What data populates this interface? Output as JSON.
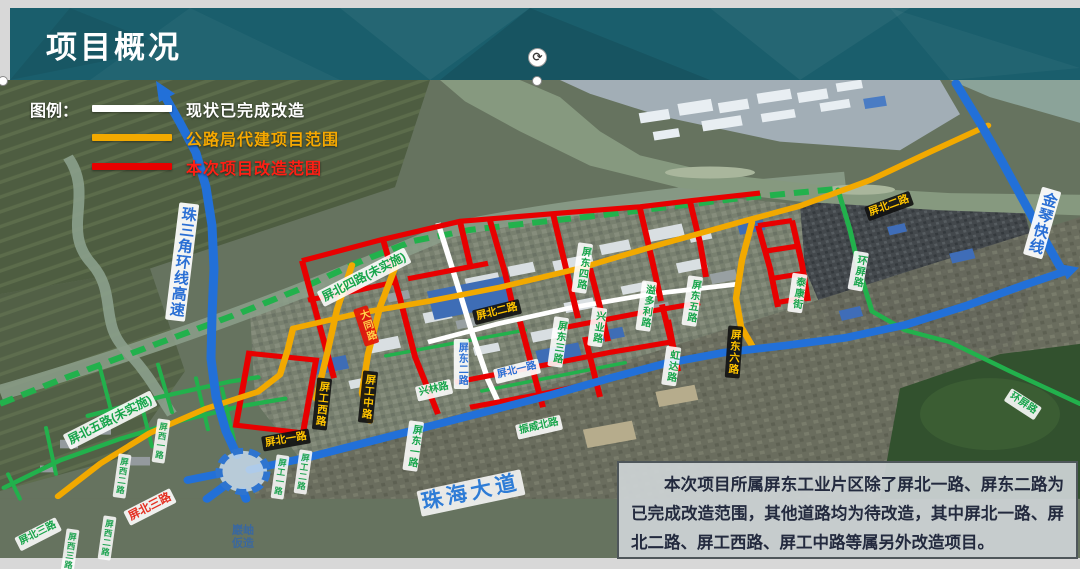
{
  "banner": {
    "title": "项目概况",
    "bg_color": "#1a5e6c"
  },
  "legend": {
    "title": "图例：",
    "items": [
      {
        "label": "现状已完成改造",
        "color": "#ffffff",
        "text_color": "#ffffff"
      },
      {
        "label": "公路局代建项目范围",
        "color": "#f2a900",
        "text_color": "#f5a800"
      },
      {
        "label": "本次项目改造范围",
        "color": "#e80000",
        "text_color": "#ff1f14"
      }
    ]
  },
  "note": {
    "text": "本次项目所属屏东工业片区除了屏北一路、屏东二路为已完成改造范围，其他道路均为待改造，其中屏北一路、屏北二路、屏工西路、屏工中路等属另外改造项目。"
  },
  "map": {
    "road_colors": {
      "completed": "#ffffff",
      "agency": "#f2a900",
      "current": "#e80000",
      "expressway": "#2270d8",
      "planned": "#22b14c",
      "local": "#22b14c"
    },
    "interchange": {
      "line1": "巖岫",
      "line2": "仮造",
      "x": 243,
      "y": 537
    },
    "labels": [
      {
        "text": "珠三角环线高速",
        "x": 182,
        "y": 262,
        "rot": 7,
        "v": true,
        "style": "hw"
      },
      {
        "text": "金琴快线",
        "x": 1042,
        "y": 223,
        "rot": 16,
        "v": true,
        "style": "hw"
      },
      {
        "text": "屏东二路",
        "x": 461,
        "y": 364,
        "rot": 0,
        "v": true,
        "style": "blue"
      },
      {
        "text": "屏北一路",
        "x": 517,
        "y": 371,
        "rot": -14,
        "v": false,
        "style": "blue"
      },
      {
        "text": "珠海大道",
        "x": 471,
        "y": 493,
        "rot": -12,
        "v": false,
        "style": "dadao"
      },
      {
        "text": "屏北二路",
        "x": 497,
        "y": 312,
        "rot": -14,
        "v": false,
        "style": "black"
      },
      {
        "text": "屏北二路",
        "x": 889,
        "y": 206,
        "rot": -20,
        "v": false,
        "style": "black"
      },
      {
        "text": "屏北一路",
        "x": 286,
        "y": 440,
        "rot": -10,
        "v": false,
        "style": "black"
      },
      {
        "text": "屏工西路",
        "x": 322,
        "y": 404,
        "rot": 6,
        "v": true,
        "style": "black"
      },
      {
        "text": "屏工中路",
        "x": 368,
        "y": 397,
        "rot": 6,
        "v": true,
        "style": "black"
      },
      {
        "text": "屏东六路",
        "x": 734,
        "y": 352,
        "rot": 4,
        "v": true,
        "style": "black"
      },
      {
        "text": "大同路",
        "x": 366,
        "y": 326,
        "rot": -18,
        "v": true,
        "style": "redbg"
      },
      {
        "text": "屏北四路(未实施)",
        "x": 364,
        "y": 277,
        "rot": -27,
        "v": false,
        "style": "green fs12"
      },
      {
        "text": "屏北五路(未实施)",
        "x": 110,
        "y": 420,
        "rot": -27,
        "v": false,
        "style": "green fs12"
      },
      {
        "text": "屏北三路",
        "x": 38,
        "y": 534,
        "rot": -27,
        "v": false,
        "style": "green"
      },
      {
        "text": "屏北三路",
        "x": 150,
        "y": 507,
        "rot": -27,
        "v": false,
        "style": "red"
      },
      {
        "text": "环屏路",
        "x": 858,
        "y": 271,
        "rot": 10,
        "v": true,
        "style": "green"
      },
      {
        "text": "环屏路",
        "x": 1023,
        "y": 404,
        "rot": 33,
        "v": false,
        "style": "green"
      },
      {
        "text": "屏东四路",
        "x": 582,
        "y": 268,
        "rot": 8,
        "v": true,
        "style": "green"
      },
      {
        "text": "兴业路",
        "x": 597,
        "y": 327,
        "rot": 8,
        "v": true,
        "style": "green"
      },
      {
        "text": "溢多利路",
        "x": 646,
        "y": 306,
        "rot": 8,
        "v": true,
        "style": "green"
      },
      {
        "text": "屏东五路",
        "x": 692,
        "y": 301,
        "rot": 8,
        "v": true,
        "style": "green"
      },
      {
        "text": "虹达路",
        "x": 671,
        "y": 366,
        "rot": 8,
        "v": true,
        "style": "green"
      },
      {
        "text": "泰康街",
        "x": 797,
        "y": 293,
        "rot": 8,
        "v": true,
        "style": "green"
      },
      {
        "text": "屏东三路",
        "x": 558,
        "y": 342,
        "rot": 8,
        "v": true,
        "style": "green"
      },
      {
        "text": "屏东一路",
        "x": 413,
        "y": 446,
        "rot": 8,
        "v": true,
        "style": "green"
      },
      {
        "text": "兴林路",
        "x": 434,
        "y": 390,
        "rot": -13,
        "v": false,
        "style": "green"
      },
      {
        "text": "振威北路",
        "x": 539,
        "y": 427,
        "rot": -13,
        "v": false,
        "style": "green"
      },
      {
        "text": "屏西一路",
        "x": 161,
        "y": 441,
        "rot": 8,
        "v": true,
        "style": "greensm"
      },
      {
        "text": "屏西二路",
        "x": 122,
        "y": 476,
        "rot": 8,
        "v": true,
        "style": "greensm"
      },
      {
        "text": "屏西二路",
        "x": 107,
        "y": 538,
        "rot": 8,
        "v": true,
        "style": "greensm"
      },
      {
        "text": "屏西三路",
        "x": 70,
        "y": 551,
        "rot": 8,
        "v": true,
        "style": "greensm"
      },
      {
        "text": "屏工一路",
        "x": 280,
        "y": 477,
        "rot": 8,
        "v": true,
        "style": "greensm"
      },
      {
        "text": "屏工二路",
        "x": 303,
        "y": 472,
        "rot": 8,
        "v": true,
        "style": "greensm"
      }
    ]
  }
}
